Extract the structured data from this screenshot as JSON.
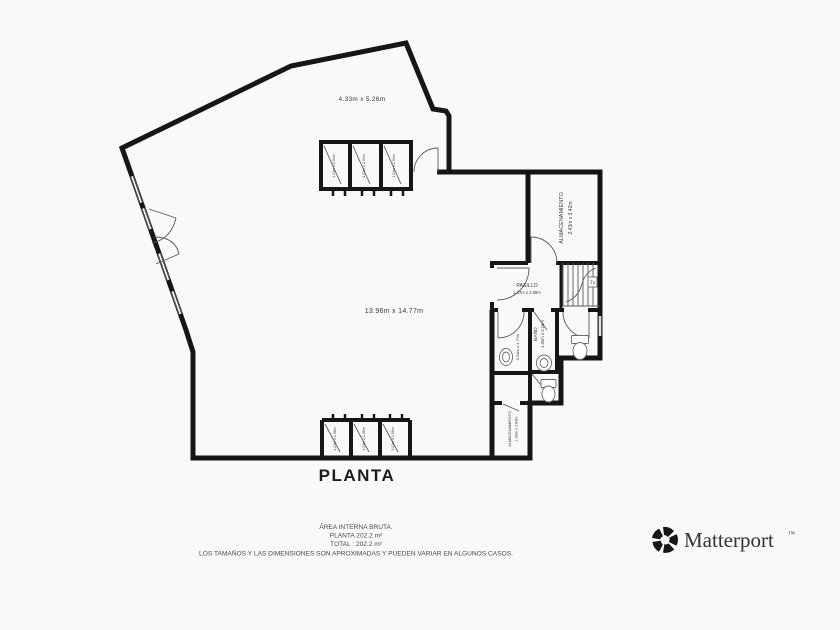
{
  "colors": {
    "wall": "#161616",
    "thin_line": "#5a5a5a",
    "label_text": "#3c3c3c",
    "background": "#faf9f7",
    "brand_text": "#333333"
  },
  "plan": {
    "title": "PLANTA",
    "rooms": {
      "top_room": {
        "dims": "4.33m x 5.26m"
      },
      "main_room": {
        "dims": "13.96m x 14.77m"
      },
      "storage": {
        "name": "ALMACENAMIENTO",
        "dims": "2.43m x 3.42m"
      },
      "hallway": {
        "name": "PASILLO",
        "dims": "1.47m x 2.08m"
      },
      "bathroom": {
        "name": "BAÑO",
        "dims": "1.35m x 2.16m"
      },
      "wc": {
        "dims": "0.94m x 1.77m"
      },
      "storage_small": {
        "name": "ALMACENAMIENTO",
        "dims": "1.09m x 2.83m"
      },
      "closets_top": [
        "1.21m x 2.04m",
        "1.21m x 2.04m",
        "1.21m x 2.04m"
      ],
      "closets_bottom": [
        "1.21m x 1.58m",
        "1.21m x 1.58m",
        "1.21m x 1.58m"
      ]
    },
    "stairs": {
      "label": "7x"
    }
  },
  "footer": {
    "area_title": "ÁREA INTERNA BRUTA.",
    "area_line": "PLANTA 202.2 m²",
    "total_line": "TOTAL :  202.2 m²",
    "disclaimer": "LOS TAMAÑOS Y LAS DIMENSIONES SON APROXIMADAS Y PUEDEN VARIAR EN ALGUNOS CASOS."
  },
  "brand": {
    "name": "Matterport",
    "trademark": "™"
  }
}
